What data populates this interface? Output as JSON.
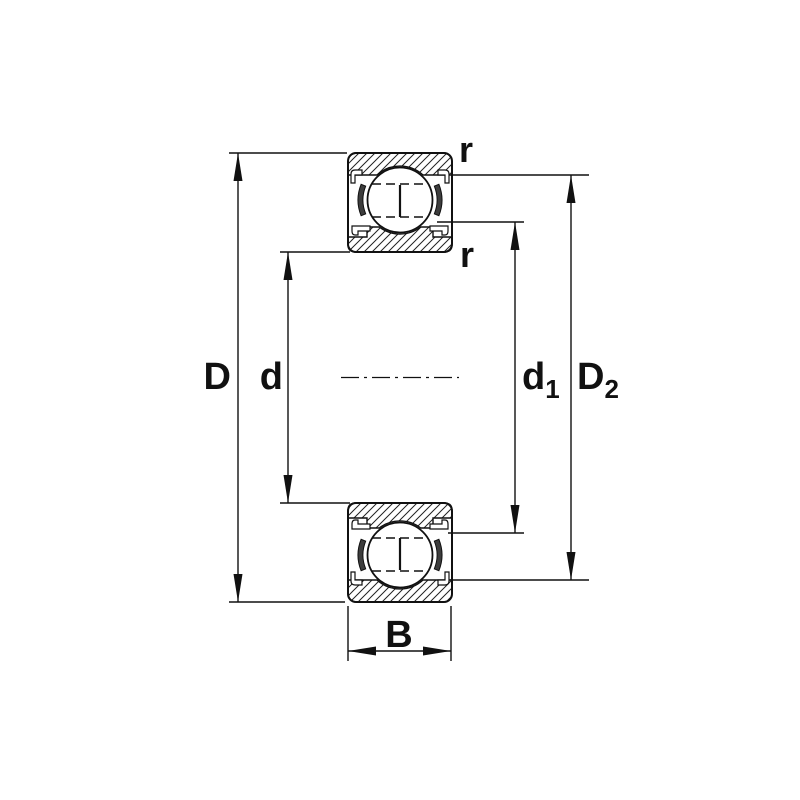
{
  "diagram": {
    "background_color": "#ffffff",
    "line_color": "#111111",
    "hatch_color": "#222222",
    "dimension_labels": {
      "outer_diameter": "D",
      "bore_diameter": "d",
      "inner_shoulder": {
        "base": "d",
        "sub": "1"
      },
      "outer_land": {
        "base": "D",
        "sub": "2"
      },
      "width": "B",
      "corner_radius_top": "r",
      "corner_radius_bottom": "r"
    }
  }
}
